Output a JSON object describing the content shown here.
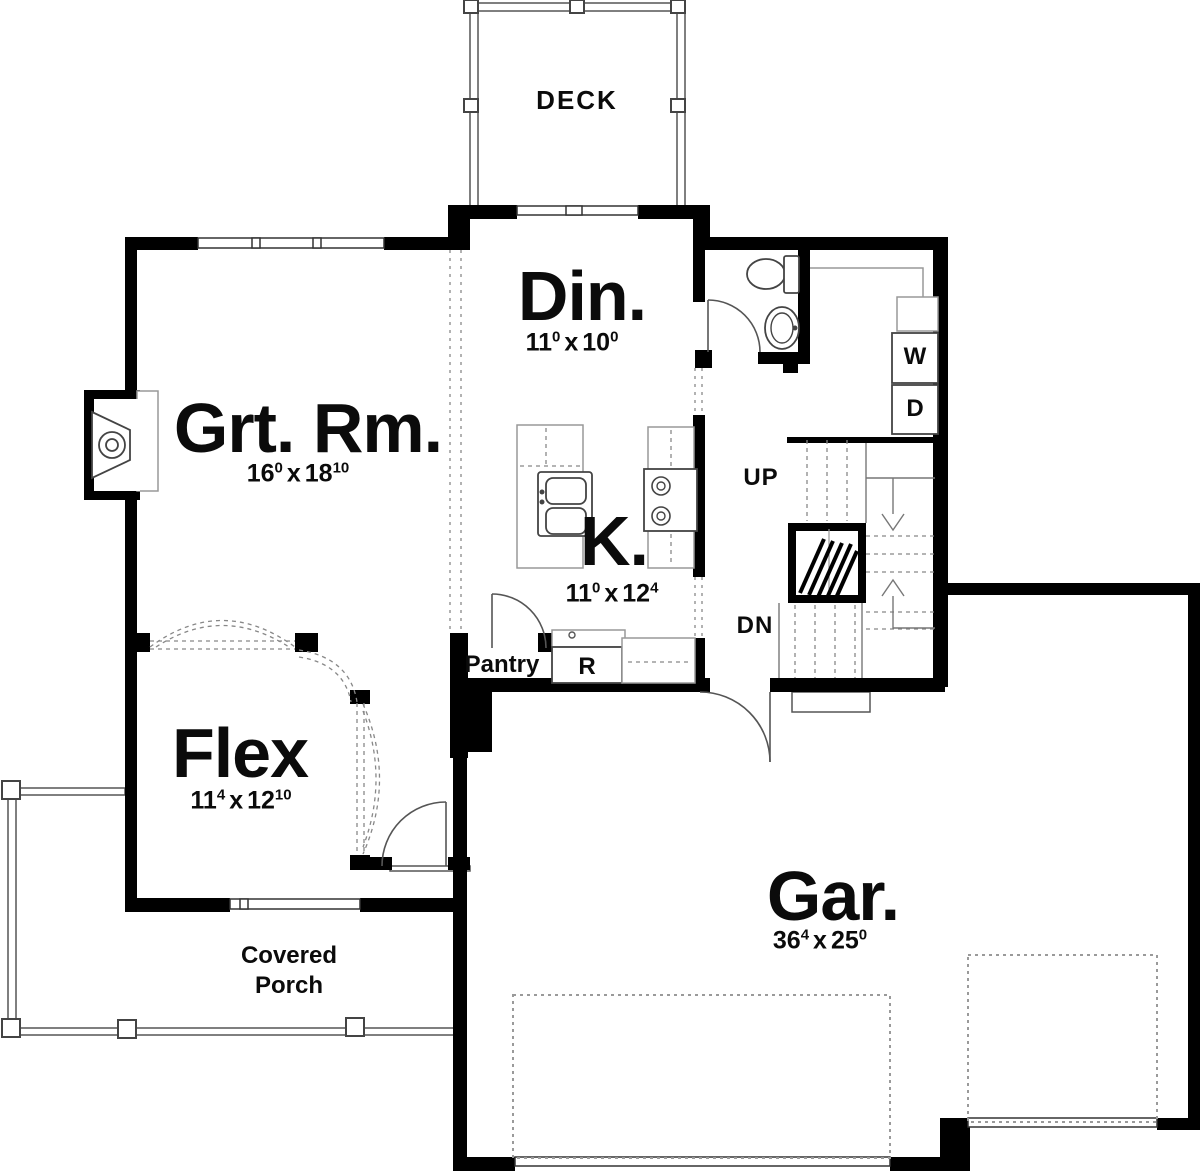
{
  "plan": {
    "rooms": {
      "deck": {
        "label": "DECK"
      },
      "dining": {
        "label": "Din.",
        "dim": {
          "w": "11",
          "w_sup": "0",
          "sep": "x",
          "h": "10",
          "h_sup": "0"
        }
      },
      "great_room": {
        "label": "Grt. Rm.",
        "dim": {
          "w": "16",
          "w_sup": "0",
          "sep": "x",
          "h": "18",
          "h_sup": "10"
        }
      },
      "kitchen": {
        "label": "K.",
        "dim": {
          "w": "11",
          "w_sup": "0",
          "sep": "x",
          "h": "12",
          "h_sup": "4"
        }
      },
      "flex": {
        "label": "Flex",
        "dim": {
          "w": "11",
          "w_sup": "4",
          "sep": "x",
          "h": "12",
          "h_sup": "10"
        }
      },
      "garage": {
        "label": "Gar.",
        "dim": {
          "w": "36",
          "w_sup": "4",
          "sep": "x",
          "h": "25",
          "h_sup": "0"
        }
      },
      "pantry": {
        "label": "Pantry"
      },
      "covered_porch": {
        "line1": "Covered",
        "line2": "Porch"
      }
    },
    "annotations": {
      "stairs_up": "UP",
      "stairs_down": "DN",
      "washer": "W",
      "dryer": "D",
      "refrigerator": "R"
    },
    "colors": {
      "wall": "#000000",
      "thin_line": "#555555",
      "light_line": "#999999",
      "background": "#ffffff"
    }
  }
}
